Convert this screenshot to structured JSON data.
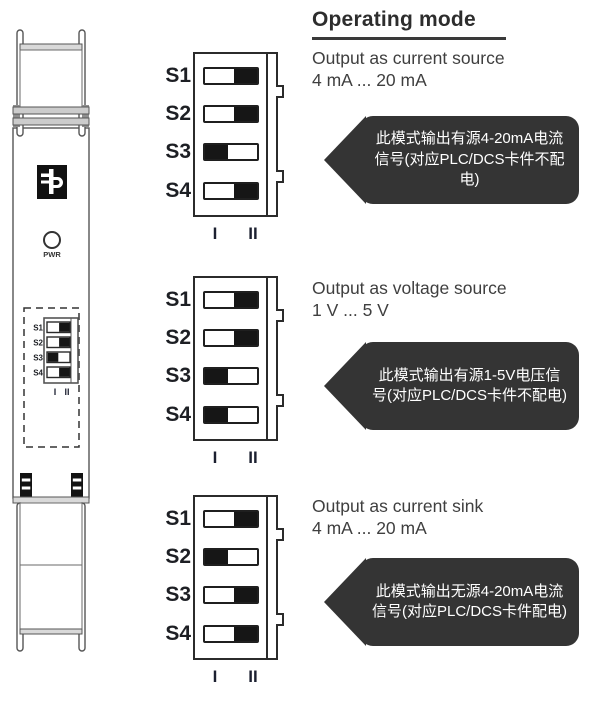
{
  "heading": "Operating mode",
  "dip_columns": [
    "I",
    "II"
  ],
  "device": {
    "pwr_label": "PWR",
    "mini_switch": {
      "labels": [
        "S1",
        "S2",
        "S3",
        "S4"
      ],
      "positions": [
        "II",
        "II",
        "I",
        "II"
      ],
      "col_labels": [
        "I",
        "II"
      ]
    }
  },
  "modes": [
    {
      "title_line1": "Output as current source",
      "title_line2": "4 mA ... 20 mA",
      "callout": "此模式输出有源4-20mA电流信号(对应PLC/DCS卡件不配电)",
      "switches": [
        {
          "label": "S1",
          "position": "II"
        },
        {
          "label": "S2",
          "position": "II"
        },
        {
          "label": "S3",
          "position": "I"
        },
        {
          "label": "S4",
          "position": "II"
        }
      ]
    },
    {
      "title_line1": "Output as voltage source",
      "title_line2": "1 V ... 5 V",
      "callout": "此模式输出有源1-5V电压信号(对应PLC/DCS卡件不配电)",
      "switches": [
        {
          "label": "S1",
          "position": "II"
        },
        {
          "label": "S2",
          "position": "II"
        },
        {
          "label": "S3",
          "position": "I"
        },
        {
          "label": "S4",
          "position": "I"
        }
      ]
    },
    {
      "title_line1": "Output as current sink",
      "title_line2": "4 mA ... 20 mA",
      "callout": "此模式输出无源4-20mA电流信号(对应PLC/DCS卡件配电)",
      "switches": [
        {
          "label": "S1",
          "position": "II"
        },
        {
          "label": "S2",
          "position": "I"
        },
        {
          "label": "S3",
          "position": "II"
        },
        {
          "label": "S4",
          "position": "II"
        }
      ]
    }
  ],
  "colors": {
    "callout_bg": "#343434",
    "callout_text": "#ffffff",
    "body_text": "#3f3f3f",
    "switch_knob": "#161616"
  }
}
